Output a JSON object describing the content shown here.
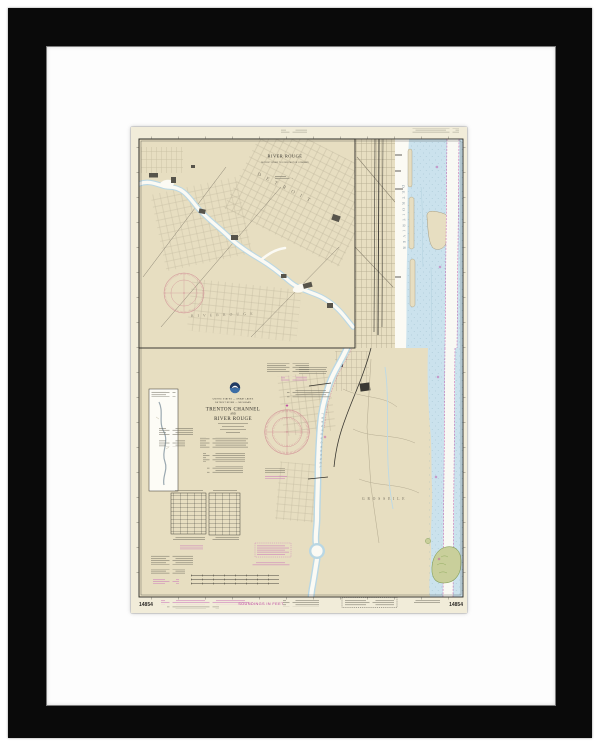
{
  "product": {
    "description_label": "Framed NOAA nautical chart print, black frame with white mat"
  },
  "colors": {
    "frame": "#0a0a0a",
    "mat": "#fdfdfd",
    "paper": "#f1ecd9",
    "land": "#e7dec1",
    "water": "#cbe2ed",
    "channel": "#fbfaf4",
    "magenta": "#bb3f9e",
    "micromag": "#cd7fbb",
    "rose": "#cf8691",
    "ink": "#33312b",
    "micro": "#6b675a",
    "grid": "#b6ad93",
    "rail": "#3a3832",
    "green": "#c9cf9b",
    "greenedge": "#86a15b",
    "noaa": "#1f3a63",
    "riverlabel": "#7f909c",
    "citylabel": "#756f60"
  },
  "inset": {
    "title": "RIVER ROUGE",
    "subtitle": "DETROIT RIVER TO FORD MOTOR COMPANY",
    "city_detroit": "D E T R O I T",
    "city_river_rouge": "R I V E R   R O U G E"
  },
  "main": {
    "nation_line": "UNITED STATES — GREAT LAKES",
    "region_line": "DETROIT RIVER — MICHIGAN",
    "title1": "TRENTON CHANNEL",
    "title_and": "AND",
    "title2": "RIVER ROUGE",
    "river_label_vertical": "D E T R O I T   R I V E R",
    "channel_label_vertical": "T R E N T O N   C H A N N E L",
    "island_label": "G R O S S E   I L E"
  },
  "margins": {
    "soundings_note": "SOUNDINGS IN FEET",
    "chart_number_left": "14854",
    "chart_number_right": "14854"
  }
}
